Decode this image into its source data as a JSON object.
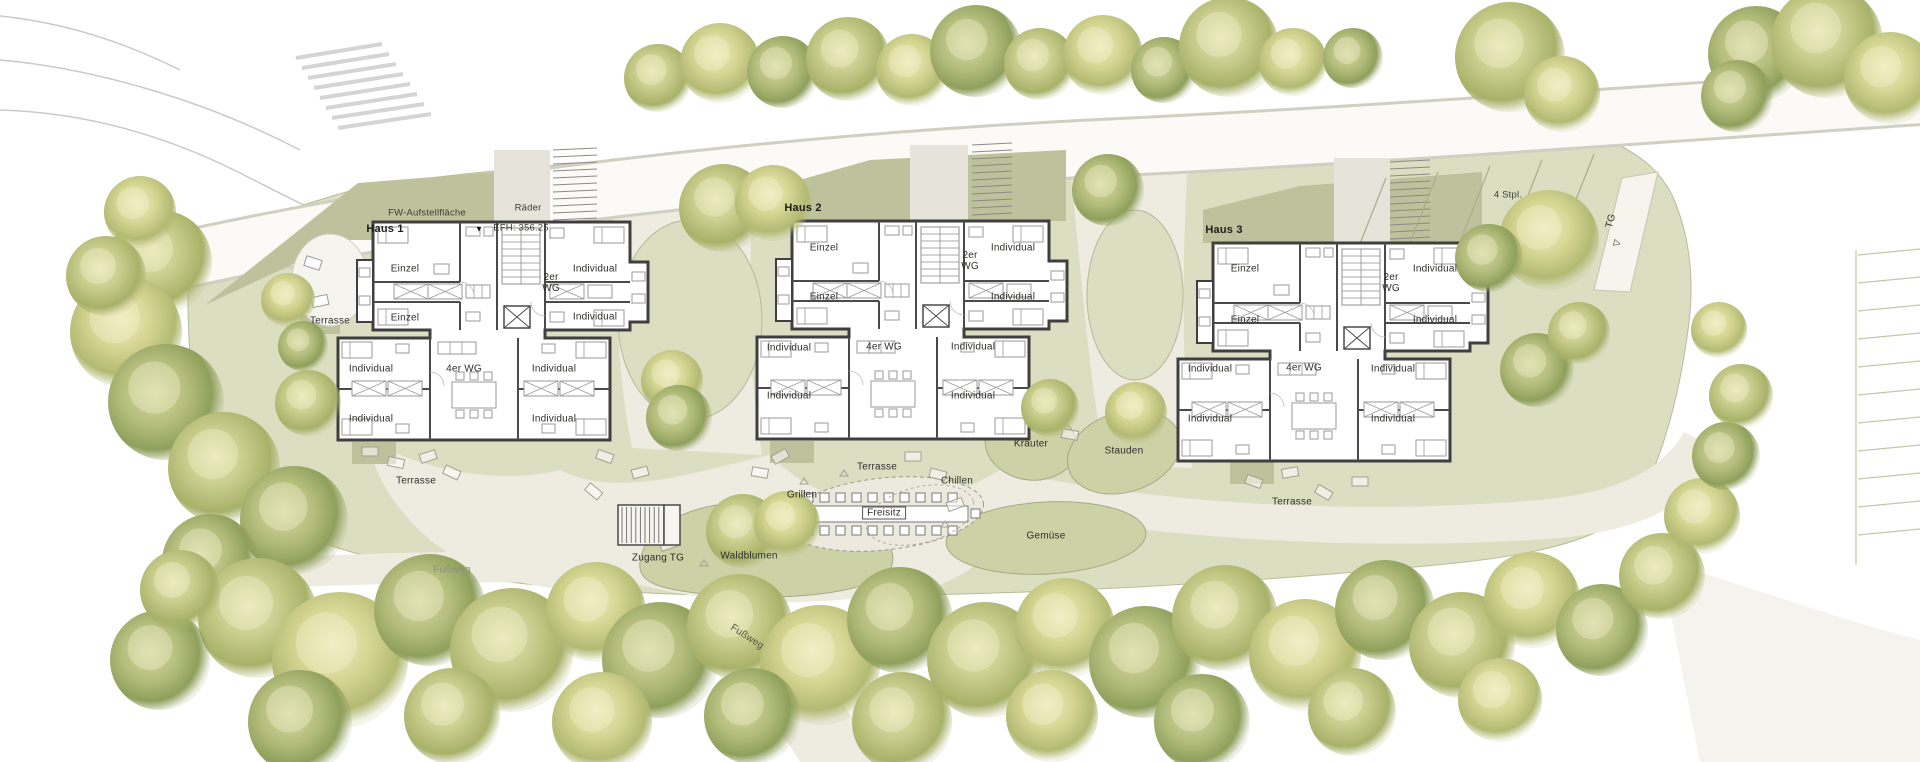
{
  "site": {
    "fw_area_label": "FW-Aufstellfläche",
    "bike_label": "Räder",
    "level_label": "EFH: 356.25",
    "parking_label": "4 Stpl.",
    "garage_label": "TG",
    "garage_access_label": "Zugang TG",
    "footpaths": [
      "Fußweg",
      "Fußweg"
    ],
    "terraces": [
      "Terrasse",
      "Terrasse",
      "Terrasse",
      "Terrasse"
    ],
    "garden": {
      "grill": "Grillen",
      "outdoor_seating": "Freisitz",
      "chill": "Chillen",
      "herbs": "Kräuter",
      "perennials": "Stauden",
      "vegetables": "Gemüse",
      "wildflowers": "Waldblumen"
    }
  },
  "icons": {
    "level_marker": "▼",
    "ramp_arrow": "▽"
  },
  "houses": [
    {
      "name": "Haus 1",
      "rooms": {
        "single_1": "Einzel",
        "single_2": "Einzel",
        "shared_2": "2er WG",
        "individual_1": "Individual",
        "individual_2": "Individual",
        "shared_4": "4er WG",
        "individual_3": "Individual",
        "individual_4": "Individual",
        "individual_5": "Individual",
        "individual_6": "Individual"
      }
    },
    {
      "name": "Haus 2",
      "rooms": {
        "single_1": "Einzel",
        "single_2": "Einzel",
        "shared_2": "2er WG",
        "individual_1": "Individual",
        "individual_2": "Individual",
        "shared_4": "4er WG",
        "individual_3": "Individual",
        "individual_4": "Individual",
        "individual_5": "Individual",
        "individual_6": "Individual"
      }
    },
    {
      "name": "Haus 3",
      "rooms": {
        "single_1": "Einzel",
        "single_2": "Einzel",
        "shared_2": "2er WG",
        "individual_1": "Individual",
        "individual_2": "Individual",
        "shared_4": "4er WG",
        "individual_3": "Individual",
        "individual_4": "Individual",
        "individual_5": "Individual",
        "individual_6": "Individual"
      }
    }
  ],
  "colors": {
    "site_green": "#dbdec1",
    "shade_green": "#bdc19c",
    "path": "#eeebe1",
    "planting": "#cdd1a6",
    "wall": "#3f3f3f"
  }
}
